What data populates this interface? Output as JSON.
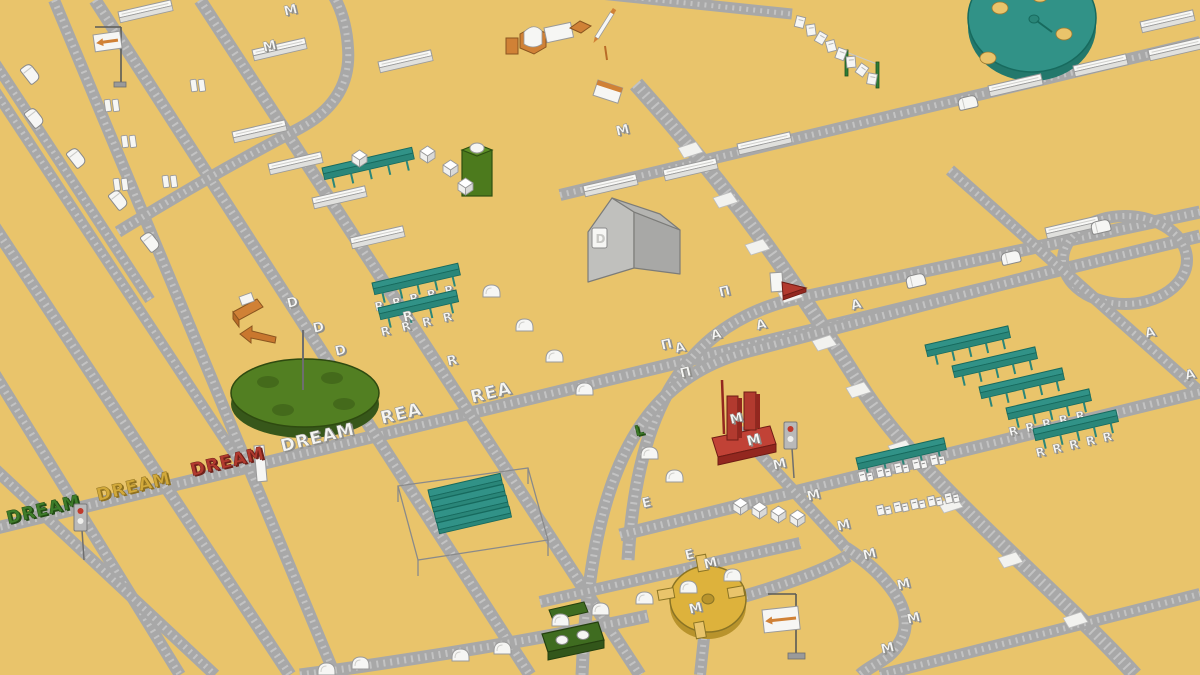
{
  "scene": {
    "title": "Isometric letter-delivery world with conveyor roads",
    "background": "#e9c46b"
  },
  "palette": {
    "road": "#a8a8a8",
    "road_stripe": "#c3c3c3",
    "white": "#f6f6f4",
    "white_shade": "#8f8f8c",
    "white_face": "#e0e0dd",
    "teal": "#319287",
    "teal_dark": "#176a5e",
    "teal_mid": "#2a8679",
    "green": "#527f22",
    "green_dark": "#2e4a10",
    "dark_green": "#3f6c20",
    "container_green": "#4c7a1d",
    "gate_green": "#2e7d35",
    "yellow_disc": "#ddb23c",
    "yellow_dark": "#8a7425",
    "red": "#b23a2f",
    "red_dark": "#6f1c15",
    "red_mid": "#93271f",
    "orange": "#d08136",
    "orange_dark": "#8a5520",
    "orange_mid": "#b96c28",
    "house_left": "#c0c0bd",
    "house_right": "#a8a8a6",
    "house_roof": "#b4b4b1",
    "house_line": "#7c7c79",
    "gray_pole": "#5a5a57"
  },
  "roads": [
    {
      "name": "road-dream-line",
      "d": "M -20 532 L 1200 236",
      "w": 13
    },
    {
      "name": "road-left-steep-a",
      "d": "M -20 205 L 290 675",
      "w": 13
    },
    {
      "name": "road-left-steep-b",
      "d": "M 54 0 L 335 675",
      "w": 12
    },
    {
      "name": "road-left-steep-c",
      "d": "M 95 0 L 530 675",
      "w": 13
    },
    {
      "name": "road-left-steep-d",
      "d": "M 200 0 L 640 675",
      "w": 13
    },
    {
      "name": "road-topleft-stub-a",
      "d": "M -20 40 L 150 300",
      "w": 11
    },
    {
      "name": "road-topleft-stub-b",
      "d": "M -20 68 L 245 470",
      "w": 11
    },
    {
      "name": "road-topleft-curve",
      "d": "M 118 232 Q 210 175 300 128 Q 352 100 348 48 Q 346 14 330 -10",
      "w": 12
    },
    {
      "name": "road-topright-shallow",
      "d": "M 560 195 L 1200 42",
      "w": 12
    },
    {
      "name": "road-chain-stub",
      "d": "M 600 -6 L 792 14",
      "w": 11
    },
    {
      "name": "road-patch-diagonal",
      "d": "M 636 84 C 740 200 800 290 862 388 C 920 480 1060 592 1135 675",
      "w": 16
    },
    {
      "name": "road-arc-inner",
      "d": "M 628 560 C 636 430 672 330 790 300 L 1200 212",
      "w": 13
    },
    {
      "name": "road-arc-outer",
      "d": "M 582 675 C 590 480 636 382 745 352 L 1063 268",
      "w": 13
    },
    {
      "name": "road-loop",
      "d": "M 1063 260 A 62 44 0 1 0 1187 260 A 62 44 0 1 0 1063 260",
      "w": 12
    },
    {
      "name": "road-right-steep",
      "d": "M 950 170 L 1200 392",
      "w": 12
    },
    {
      "name": "road-cube-row",
      "d": "M 620 535 L 1200 392",
      "w": 13
    },
    {
      "name": "road-bottom-curve",
      "d": "M 300 675 Q 500 648 648 616",
      "w": 13
    },
    {
      "name": "road-turntable-exit",
      "d": "M 745 596 Q 820 574 848 556",
      "w": 13
    },
    {
      "name": "road-m-curve",
      "d": "M 846 548 C 886 574 918 612 900 642 C 890 660 872 664 860 675",
      "w": 13
    },
    {
      "name": "road-bottom-stub",
      "d": "M 704 638 L 700 675",
      "w": 12
    },
    {
      "name": "road-left-bottom-a",
      "d": "M -20 350 L 180 675",
      "w": 12
    },
    {
      "name": "road-e-shallow",
      "d": "M 540 602 L 800 543",
      "w": 12
    },
    {
      "name": "road-left-bottom-b",
      "d": "M -20 455 L 215 675",
      "w": 12
    },
    {
      "name": "road-bottom-right",
      "d": "M 880 675 L 1200 594",
      "w": 12
    },
    {
      "name": "road-m-column",
      "d": "M 736 428 L 846 548",
      "w": 12
    }
  ],
  "patches": [
    [
      690,
      150
    ],
    [
      725,
      200
    ],
    [
      757,
      247
    ],
    [
      790,
      295
    ],
    [
      824,
      343
    ],
    [
      858,
      390
    ],
    [
      900,
      448
    ],
    [
      950,
      505
    ],
    [
      1010,
      560
    ],
    [
      1075,
      620
    ]
  ],
  "words": [
    {
      "text": "DREAM",
      "x": 8,
      "y": 524,
      "fill": "#3e7c2a",
      "shade": "#234d15",
      "name": "word-dream-green"
    },
    {
      "text": "DREAM",
      "x": 98,
      "y": 501,
      "fill": "#d2a93a",
      "shade": "#8f7120",
      "name": "word-dream-yellow"
    },
    {
      "text": "DREAM",
      "x": 192,
      "y": 476,
      "fill": "#b23a2f",
      "shade": "#6f211a",
      "name": "word-dream-red"
    },
    {
      "text": "DREAM",
      "x": 282,
      "y": 452,
      "fill": "#f5f5f2",
      "shade": "#8f8f8c",
      "name": "word-dream-white"
    },
    {
      "text": "REA",
      "x": 382,
      "y": 424,
      "fill": "#f5f5f2",
      "shade": "#8f8f8c",
      "name": "word-rea-1"
    },
    {
      "text": "REA",
      "x": 472,
      "y": 403,
      "fill": "#f5f5f2",
      "shade": "#8f8f8c",
      "name": "word-rea-2"
    }
  ],
  "letters": [
    [
      "M",
      285,
      16
    ],
    [
      "M",
      264,
      52
    ],
    [
      "M",
      617,
      136
    ],
    [
      "M",
      774,
      470
    ],
    [
      "M",
      808,
      501
    ],
    [
      "M",
      838,
      531
    ],
    [
      "M",
      864,
      560
    ],
    [
      "M",
      898,
      590
    ],
    [
      "M",
      908,
      624
    ],
    [
      "M",
      882,
      654
    ],
    [
      "M",
      705,
      569
    ],
    [
      "M",
      690,
      614
    ],
    [
      "R",
      404,
      322
    ],
    [
      "R",
      448,
      366
    ],
    [
      "D",
      288,
      308
    ],
    [
      "D",
      314,
      333
    ],
    [
      "D",
      336,
      356
    ],
    [
      "E",
      643,
      508
    ],
    [
      "E",
      686,
      560
    ],
    [
      "А",
      757,
      330
    ],
    [
      "А",
      852,
      310
    ],
    [
      "А",
      676,
      353
    ],
    [
      "А",
      1146,
      338
    ],
    [
      "А",
      1186,
      380
    ],
    [
      "А",
      712,
      340
    ],
    [
      "П",
      720,
      297
    ],
    [
      "П",
      662,
      350
    ],
    [
      "П",
      681,
      378
    ]
  ],
  "green_letter": {
    "text": "L",
    "x": 636,
    "y": 436,
    "fill": "#3c7a28",
    "shade": "#255114"
  },
  "cars": [
    [
      30,
      62,
      52
    ],
    [
      34,
      106,
      52
    ],
    [
      76,
      146,
      52
    ],
    [
      118,
      188,
      52
    ],
    [
      150,
      230,
      52
    ],
    [
      905,
      276,
      -13
    ],
    [
      1000,
      253,
      -13
    ],
    [
      1090,
      222,
      -13
    ],
    [
      957,
      98,
      -13
    ]
  ],
  "blobs": [
    [
      483,
      282
    ],
    [
      516,
      316
    ],
    [
      546,
      347
    ],
    [
      576,
      380
    ],
    [
      641,
      444
    ],
    [
      666,
      467
    ],
    [
      592,
      600
    ],
    [
      636,
      589
    ],
    [
      552,
      611
    ],
    [
      452,
      646
    ],
    [
      494,
      639
    ],
    [
      680,
      578
    ],
    [
      724,
      566
    ],
    [
      318,
      660
    ],
    [
      352,
      654
    ]
  ],
  "cubes": [
    [
      352,
      150
    ],
    [
      420,
      146
    ],
    [
      443,
      160
    ],
    [
      458,
      178
    ],
    [
      733,
      498
    ],
    [
      752,
      502
    ],
    [
      771,
      506
    ],
    [
      790,
      510
    ]
  ],
  "bars": [
    [
      118,
      12
    ],
    [
      252,
      50
    ],
    [
      232,
      132
    ],
    [
      268,
      164
    ],
    [
      312,
      198
    ],
    [
      350,
      238
    ],
    [
      378,
      62
    ],
    [
      583,
      186
    ],
    [
      663,
      170
    ],
    [
      737,
      144
    ],
    [
      988,
      86
    ],
    [
      1073,
      66
    ],
    [
      1148,
      50
    ],
    [
      1045,
      228
    ],
    [
      1140,
      22
    ]
  ],
  "letter_pairs": [
    [
      104,
      100
    ],
    [
      121,
      136
    ],
    [
      113,
      179
    ],
    [
      162,
      176
    ],
    [
      190,
      80
    ]
  ],
  "racks": {
    "left_single": {
      "x": 322,
      "y": 168,
      "len": 92,
      "hooks": 5,
      "letters": ""
    },
    "left_double": [
      {
        "x": 372,
        "y": 283,
        "len": 88,
        "hooks": 5,
        "letters": "R"
      },
      {
        "x": 378,
        "y": 308,
        "len": 80,
        "hooks": 4,
        "letters": "R"
      }
    ],
    "right_group": {
      "x": 925,
      "y": 345,
      "len": 85,
      "rows": 5,
      "step_x": 27,
      "step_y": 21,
      "letter_rows": [
        3,
        4
      ],
      "letters": "R"
    },
    "pair_rack": {
      "x": 856,
      "y": 458,
      "len": 90,
      "pairs": 5
    },
    "pair_row": {
      "x": 876,
      "y": 506,
      "pairs": 5,
      "step_x": 17,
      "step_y": -3
    }
  },
  "discs": {
    "teal_disc": {
      "cx": 1032,
      "cy": 18,
      "rx": 64,
      "ry": 54,
      "holes": [
        [
          1000,
          8
        ],
        [
          1064,
          34
        ],
        [
          988,
          58
        ],
        [
          1040,
          -4
        ]
      ]
    },
    "green_carousel": {
      "cx": 305,
      "cy": 393,
      "rx": 74,
      "ry": 34,
      "spots": [
        [
          268,
          382
        ],
        [
          332,
          378
        ],
        [
          283,
          410
        ],
        [
          344,
          404
        ]
      ]
    },
    "yellow_turntable": {
      "cx": 708,
      "cy": 599,
      "rx": 38,
      "ry": 33
    }
  },
  "chain": [
    [
      800,
      22,
      14
    ],
    [
      811,
      30,
      -8
    ],
    [
      821,
      38,
      30
    ],
    [
      831,
      46,
      -15
    ],
    [
      841,
      54,
      20
    ],
    [
      851,
      62,
      -5
    ],
    [
      862,
      70,
      35
    ],
    [
      872,
      79,
      10
    ]
  ],
  "gate_posts": [
    [
      845,
      50
    ],
    [
      876,
      62
    ]
  ],
  "signs": [
    {
      "name": "sign-top-left",
      "plate": [
        93,
        35,
        27,
        17
      ],
      "rot": -8,
      "pole": [
        [
          121,
          27
        ],
        [
          121,
          84
        ]
      ],
      "arm": [
        [
          95,
          27
        ],
        [
          121,
          27
        ]
      ],
      "base": [
        114,
        82,
        12,
        5
      ]
    },
    {
      "name": "sign-bottom-center",
      "plate": [
        762,
        610,
        36,
        23
      ],
      "rot": -6,
      "pole": [
        [
          796,
          594
        ],
        [
          796,
          654
        ]
      ],
      "arm": [
        [
          768,
          594
        ],
        [
          796,
          594
        ]
      ],
      "base": [
        788,
        653,
        17,
        6
      ]
    }
  ],
  "traffic_lights": [
    [
      74,
      504
    ],
    [
      784,
      422
    ]
  ],
  "stationery": {
    "small_box": [
      506,
      38
    ],
    "open_box": [
      520,
      28
    ],
    "card": [
      544,
      28
    ],
    "diamond": [
      570,
      22
    ],
    "pencil": [
      604,
      26
    ],
    "stick": [
      605,
      46
    ],
    "notepad": [
      598,
      80
    ]
  },
  "ramps": {
    "orange": [
      233,
      300
    ],
    "red": [
      770,
      274
    ]
  },
  "greens": {
    "container": [
      462,
      146
    ],
    "platform": [
      542,
      628
    ],
    "pad": [
      549,
      606
    ]
  },
  "pergola": {
    "outline": [
      [
        398,
        486
      ],
      [
        528,
        468
      ],
      [
        548,
        540
      ],
      [
        418,
        560
      ]
    ],
    "slat_x": 428,
    "slat_y": 490,
    "slat_count": 4,
    "slat_len": 74,
    "slat_step": 11,
    "post_h": 16
  },
  "panel": [
    254,
    446
  ],
  "house": {
    "letter": "D"
  },
  "monument": {
    "letters": [
      "M",
      "M"
    ]
  }
}
